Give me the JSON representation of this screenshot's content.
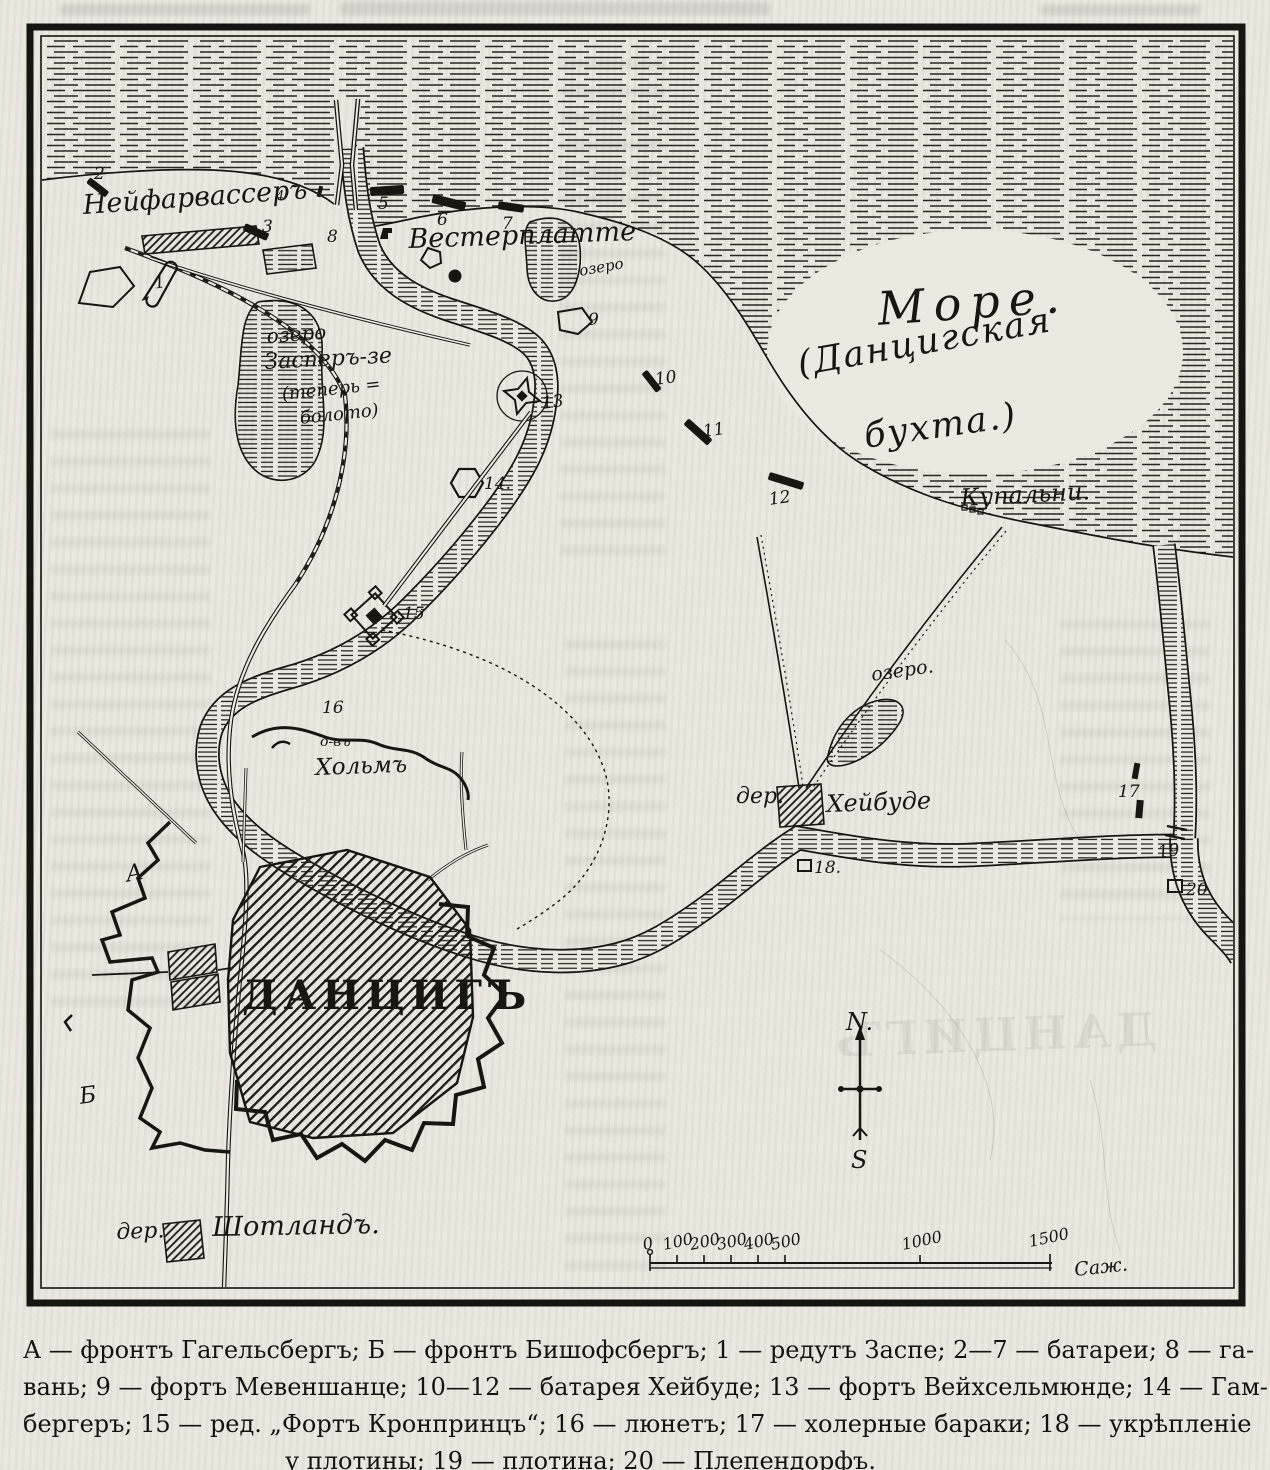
{
  "map": {
    "labels": {
      "neufahrwasser": "Нейфарвассеръ",
      "westerplatte": "Вестерплатте",
      "lake_wp": "озеро",
      "zasper_line1": "озеро",
      "zasper_line2": "Засперъ-зе",
      "zasper_line3": "(теперь =",
      "zasper_line4": "болото)",
      "sea_line1": "Море.",
      "sea_line2": "(Данцигская",
      "sea_line3": "бухта.)",
      "kupalni": "Купальни.",
      "holm_prefix": "о-въ",
      "holm": "Хольмъ",
      "heubude_prefix": "дер.",
      "heubude": "Хейбуде",
      "lake_heubude": "озеро.",
      "danzig": "ДАНЦИГЪ",
      "front_a": "А",
      "front_b": "Б",
      "schottland_prefix": "дер.",
      "schottland": "Шотландъ."
    },
    "markers": [
      "1",
      "2",
      "3",
      "4",
      "5",
      "6",
      "7",
      "8",
      "9",
      "10",
      "11",
      "12",
      "13",
      "14.",
      "15",
      "16",
      "17",
      "18.",
      "19",
      "20"
    ],
    "compass": {
      "north": "N.",
      "south": "S"
    },
    "scale": {
      "ticks": [
        "0",
        "100",
        "200",
        "300",
        "400",
        "500",
        "1000",
        "1500"
      ],
      "unit": "Саж."
    },
    "colors": {
      "ink": "#17160f",
      "paper": "#ece9e0"
    }
  },
  "legend": {
    "lines": [
      "А — фронтъ Гагельсбергъ;  Б — фронтъ Бишофсбергъ;  1 — редутъ Заспе;  2—7 — батареи;  8 — га-",
      "вань;  9 — фортъ Мевеншанце;  10—12 — батарея Хейбуде;  13 — фортъ Вейхсельмюнде;  14 — Гам-",
      "бергеръ;  15 — ред. „Фортъ Кронпринцъ“;  16 — люнетъ;  17 — холерные бараки;  18 — укрѣпленіе",
      "у плотины;  19 — плотина;  20 — Плепендорфъ."
    ]
  }
}
